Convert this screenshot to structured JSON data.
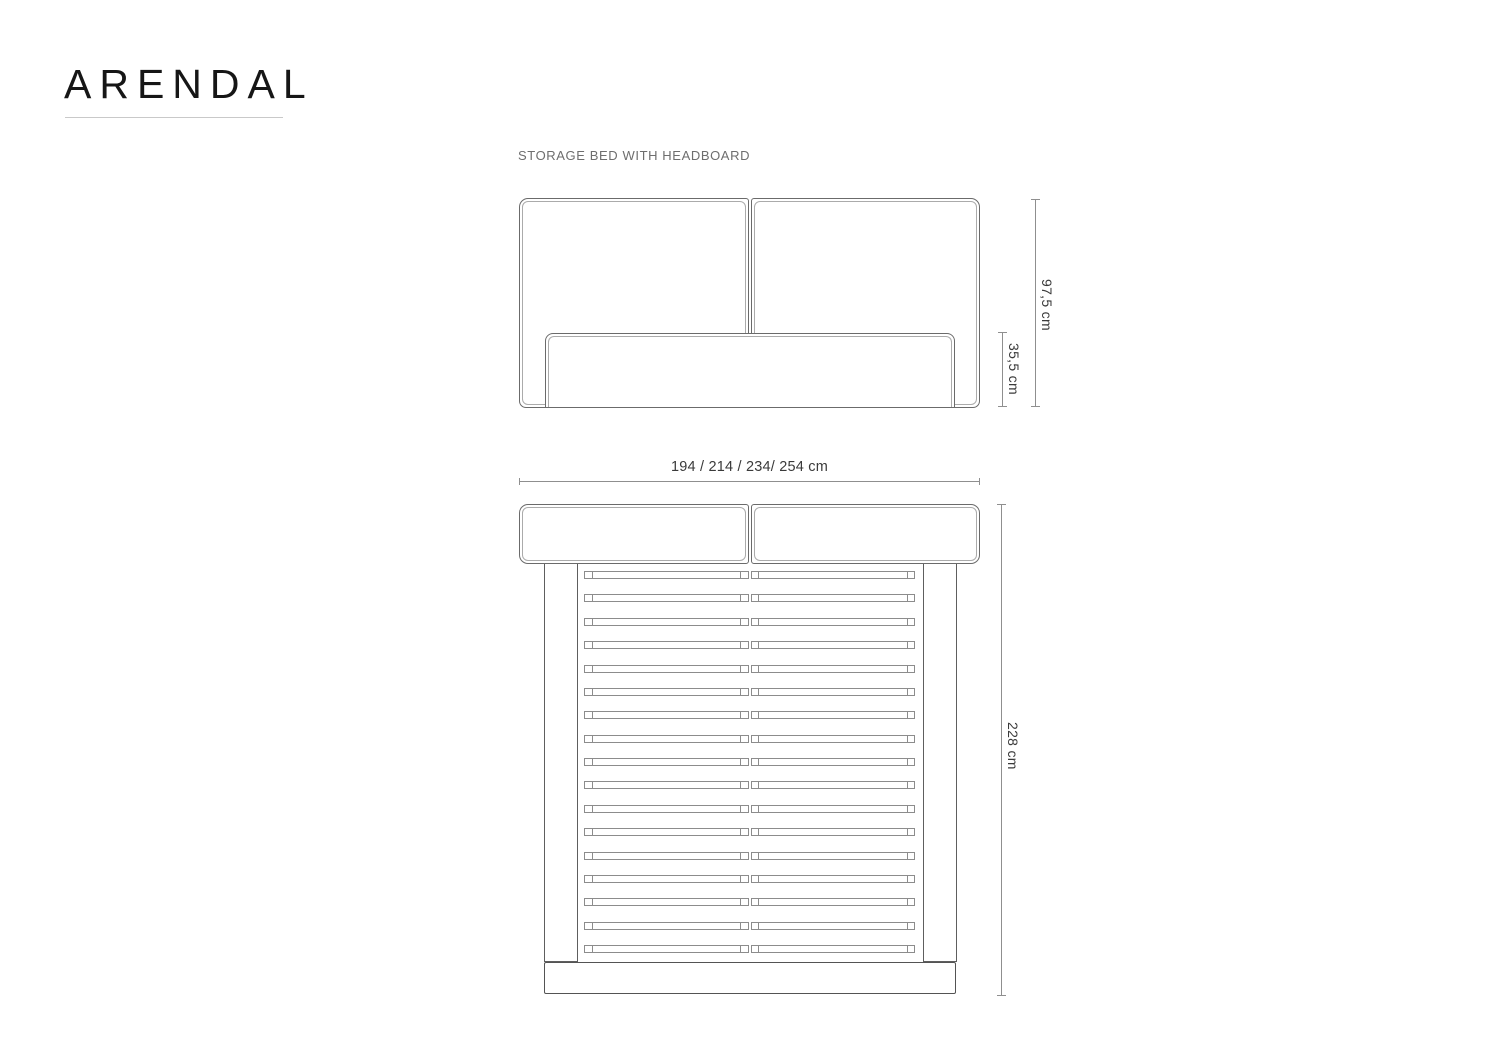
{
  "header": {
    "title": "ARENDAL",
    "subtitle": "STORAGE BED WITH HEADBOARD"
  },
  "front_view": {
    "overall_height": "97,5 cm",
    "base_height": "35,5 cm"
  },
  "top_view": {
    "width_options": "194 / 214 / 234/ 254 cm",
    "length": "228 cm",
    "slat_count": 17
  },
  "colors": {
    "background": "#ffffff",
    "panel_line": "#6b6b6b",
    "panel_seam": "#ababab",
    "frame_line": "#5e5e5e",
    "slat_line": "#8c8c8c",
    "dimension_line": "#8f8f8f",
    "dimension_text": "#3a3a3a",
    "title_text": "#161616",
    "subtitle_text": "#6e6e6e"
  }
}
